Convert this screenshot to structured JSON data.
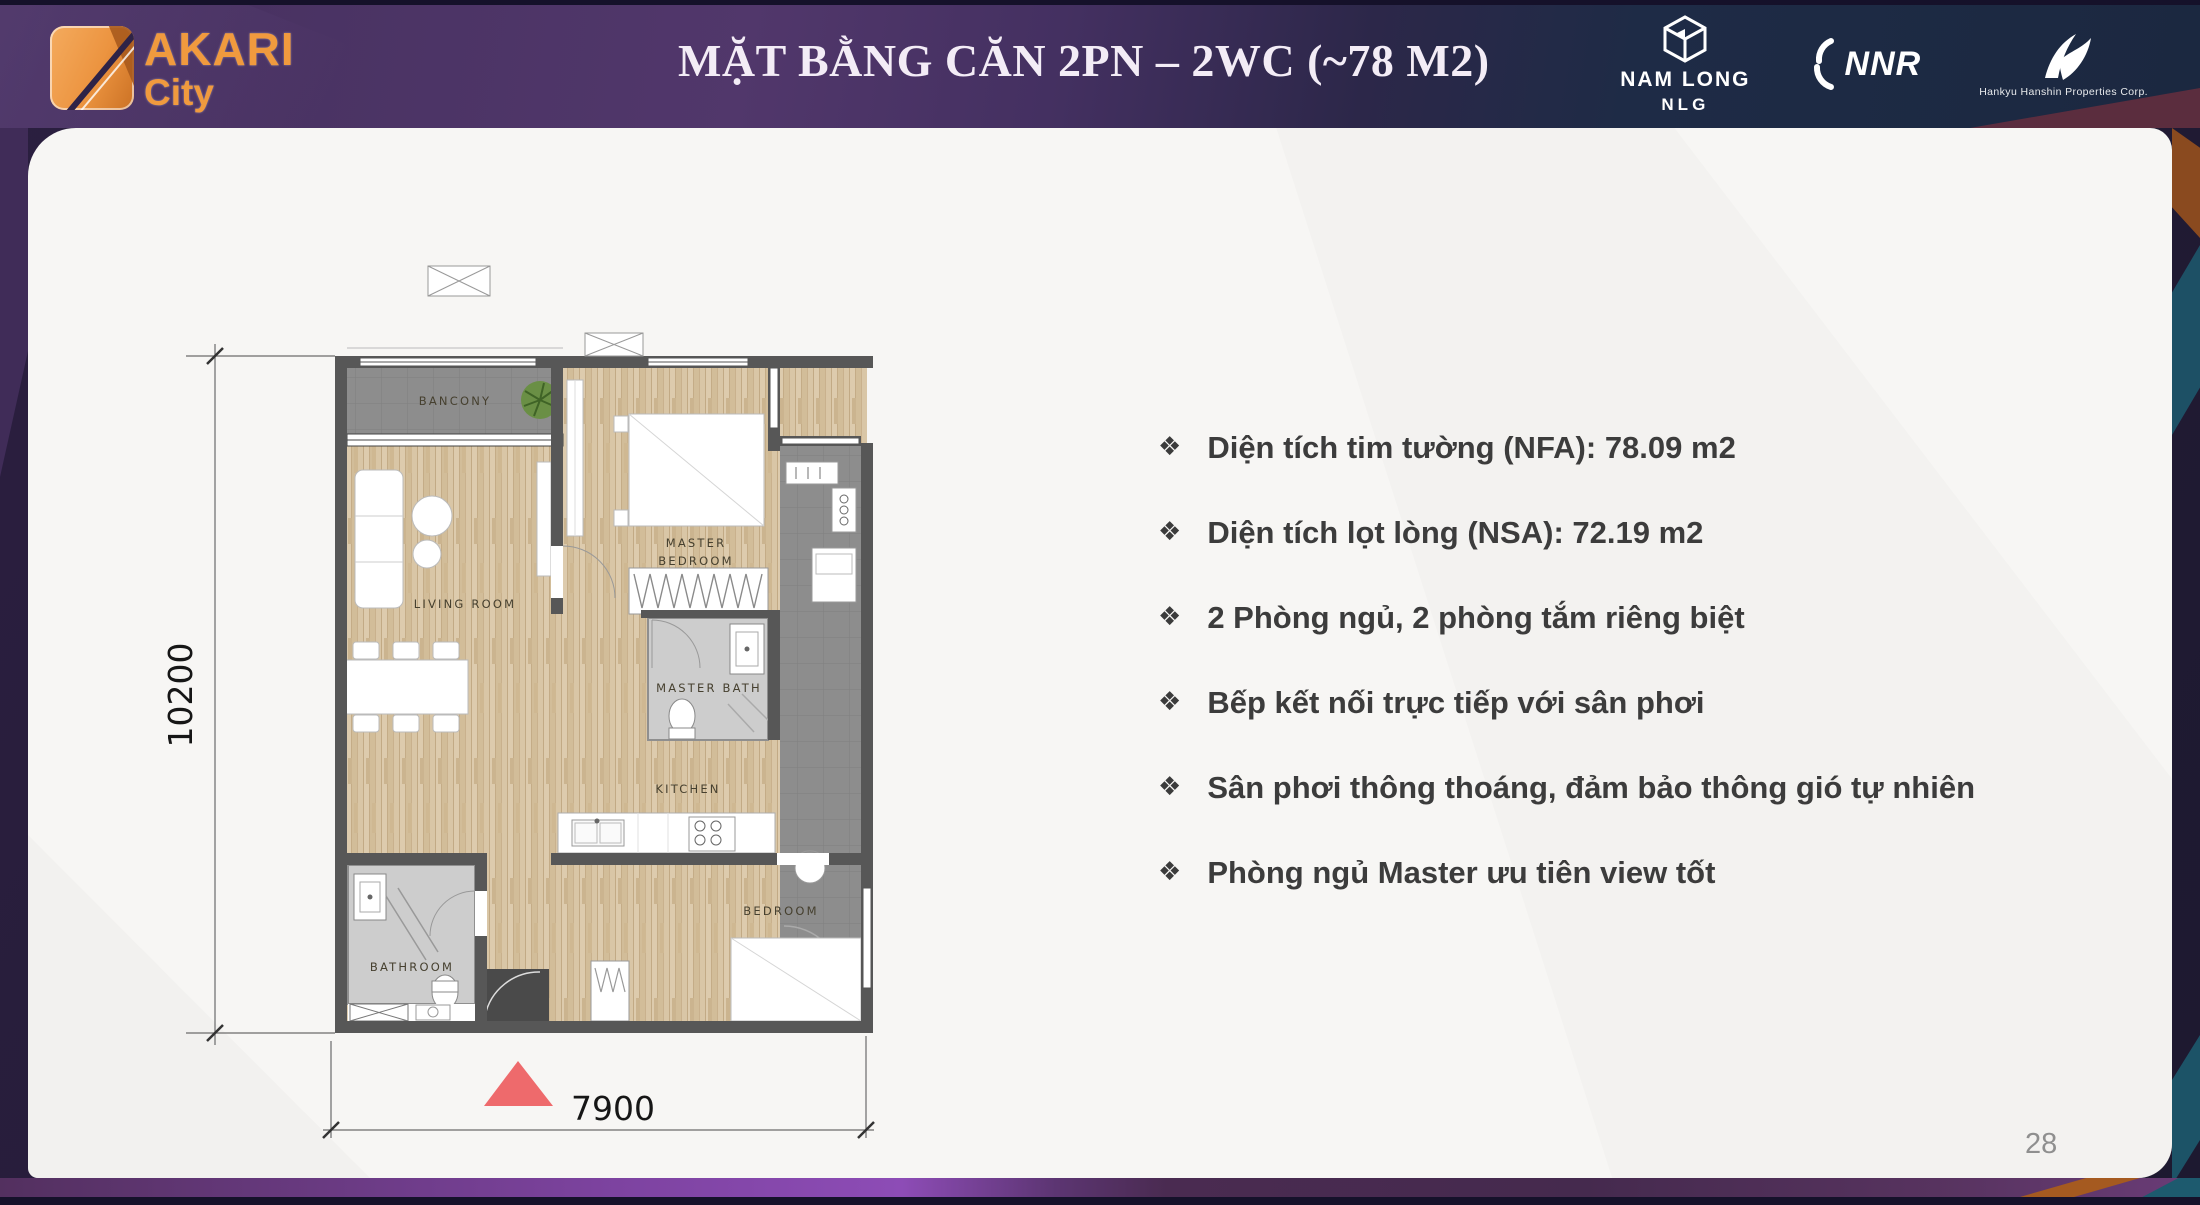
{
  "header": {
    "title": "MẶT BẰNG CĂN 2PN – 2WC (~78 M2)",
    "brand": {
      "name": "AKARI",
      "sub": "City"
    },
    "partners": {
      "namlong": {
        "name": "NAM LONG",
        "code": "NLG"
      },
      "nnr": {
        "name": "NNR"
      },
      "hankyu": {
        "caption": "Hankyu Hanshin Properties Corp."
      }
    }
  },
  "plan": {
    "labels": {
      "balcony": "BANCONY",
      "living_room": "LIVING ROOM",
      "master_bedroom_line1": "MASTER",
      "master_bedroom_line2": "BEDROOM",
      "master_bath": "MASTER BATH",
      "kitchen": "KITCHEN",
      "bedroom": "BEDROOM",
      "bathroom": "BATHROOM"
    },
    "dimensions": {
      "height_mm": "10200",
      "width_mm": "7900"
    }
  },
  "bullets": {
    "marker": "❖",
    "items": [
      "Diện tích tim tường (NFA): 78.09 m2",
      "Diện tích lọt lòng (NSA): 72.19 m2",
      "2 Phòng ngủ, 2 phòng tắm riêng biệt",
      "Bếp  kết nối trực tiếp với sân phơi",
      "Sân phơi thông thoáng, đảm bảo thông gió tự nhiên",
      "Phòng ngủ Master ưu tiên view tốt"
    ]
  },
  "footer": {
    "page_number": "28"
  },
  "colors": {
    "accent_orange": "#F09A3E",
    "header_purple": "#4A3263",
    "header_navy": "#1C2942",
    "entry_marker_red": "#EE6A6C",
    "wood_floor": "#D7C3A2",
    "tile_gray": "#8E8E8E",
    "wall_gray": "#575757"
  }
}
